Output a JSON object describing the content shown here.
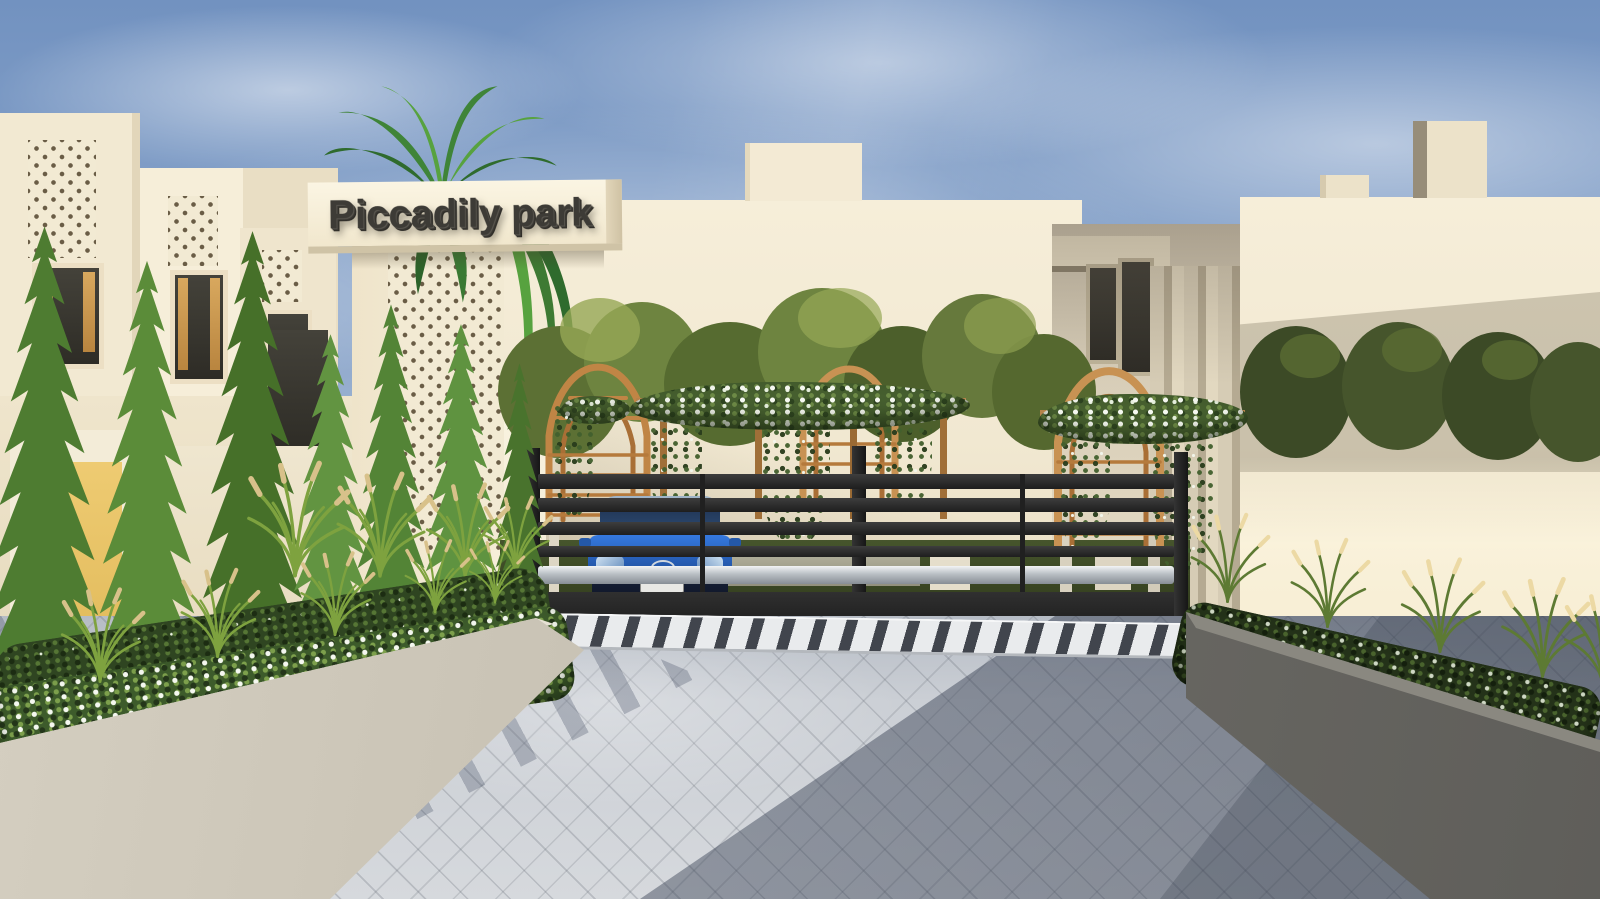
{
  "scene": {
    "description": "3D architectural rendering of a gated residential community entrance on a sunny day",
    "sign": {
      "text": "Piccadily park"
    },
    "car": {
      "color_name": "blue",
      "brand_icon": "mazda-logo",
      "license_plate_visible": true
    },
    "objects": [
      "sky-with-soft-clouds",
      "left-row-of-cream-villas",
      "perforated-mashrabiya-lattice-panels",
      "yellow-entry-door",
      "tall-conifer-trees",
      "entrance-pylon-with-sign",
      "palm-tree",
      "central-garden-wall",
      "three-wooden-arch-trellises",
      "white-climbing-rose-garland",
      "black-horizontal-slat-gate",
      "chrome-gate-rail",
      "blue-sedan-behind-gate",
      "white-rumble-strip",
      "left-concrete-planter-with-groundcover-and-grasses",
      "right-concrete-planter-in-shade",
      "right-cream-building-with-parapet-blocks",
      "herringbone-paver-driveway",
      "tree-shadows-on-paving"
    ],
    "palette": {
      "sky_top": "#7292c0",
      "sky_horizon": "#cfd8e4",
      "cream_lit": "#f4ecd6",
      "cream_shade": "#d8cfba",
      "lattice_hole": "#6a5d46",
      "door_yellow": "#e9c76a",
      "window_wood": "#c79a55",
      "window_glass": "#35342f",
      "gate_metal": "#262626",
      "gate_chrome": "#d7dadc",
      "car_blue": "#2f6fd0",
      "arch_wood": "#c58f4a",
      "conifer_green": "#4e7c31",
      "tree_olive": "#66793c",
      "flower_white": "#f5f8f0",
      "grass_plume": "#d8c18a",
      "planter_concrete": "#cac3b4",
      "planter_dark": "#6f6d69",
      "paving_lit": "#cdd1d6",
      "paving_shadow": "#8d95a1",
      "strip_white": "#e9ebed",
      "strip_dark": "#41454d"
    }
  }
}
